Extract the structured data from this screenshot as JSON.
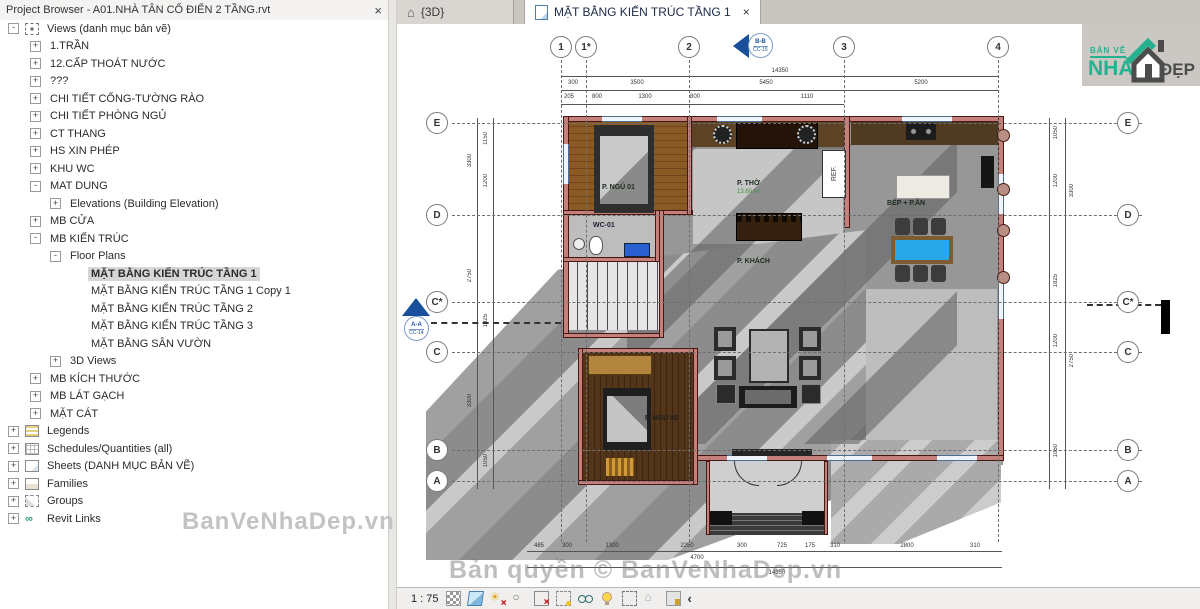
{
  "browser": {
    "title": "Project Browser - A01.NHÀ TÂN CỔ ĐIỂN 2 TẦNG.rvt",
    "close": "×",
    "watermark": "BanVeNhaDep.vn",
    "items": [
      {
        "label": "Views (danh mục bản vẽ)",
        "expanded": true
      },
      {
        "label": "1.TRẦN",
        "expanded": false
      },
      {
        "label": "12.CẤP THOÁT NƯỚC",
        "expanded": false
      },
      {
        "label": "???",
        "expanded": false
      },
      {
        "label": "CHI TIẾT CỔNG-TƯỜNG RÀO",
        "expanded": false
      },
      {
        "label": "CHI TIẾT PHÒNG NGỦ",
        "expanded": false
      },
      {
        "label": "CT THANG",
        "expanded": false
      },
      {
        "label": "HS XIN PHÉP",
        "expanded": false
      },
      {
        "label": "KHU WC",
        "expanded": false
      },
      {
        "label": "MAT DUNG",
        "expanded": true
      },
      {
        "label": "Elevations (Building Elevation)",
        "expanded": false
      },
      {
        "label": "MB CỬA",
        "expanded": false
      },
      {
        "label": "MB KIẾN TRÚC",
        "expanded": true
      },
      {
        "label": "Floor Plans",
        "expanded": true
      },
      {
        "label": "MẶT BẰNG KIẾN TRÚC TẦNG 1",
        "selected": true
      },
      {
        "label": "MẶT BẰNG KIẾN TRÚC TẦNG 1 Copy 1"
      },
      {
        "label": "MẶT BẰNG KIẾN TRÚC TẦNG 2"
      },
      {
        "label": "MẶT BẰNG KIẾN TRÚC TẦNG 3"
      },
      {
        "label": "MẶT BẰNG SÂN VƯỜN"
      },
      {
        "label": "3D Views",
        "expanded": false
      },
      {
        "label": "MB KÍCH THƯỚC",
        "expanded": false
      },
      {
        "label": "MB LÁT GẠCH",
        "expanded": false
      },
      {
        "label": "MẶT CÁT",
        "expanded": false
      },
      {
        "label": "Legends",
        "expanded": false
      },
      {
        "label": "Schedules/Quantities (all)",
        "expanded": false
      },
      {
        "label": "Sheets (DANH MỤC BẢN VẼ)",
        "expanded": false
      },
      {
        "label": "Families",
        "expanded": false
      },
      {
        "label": "Groups",
        "expanded": false
      },
      {
        "label": "Revit Links",
        "expanded": false
      }
    ]
  },
  "tabs": {
    "three_d": "{3D}",
    "active": "MẶT BẰNG KIẾN TRÚC TẦNG 1",
    "close": "×"
  },
  "logo": {
    "top": "BẢN VẼ",
    "main": "NHÀ",
    "suffix": "ĐẸP"
  },
  "plan": {
    "grids": {
      "top": [
        "1",
        "1*",
        "2",
        "3",
        "4"
      ],
      "left": [
        "E",
        "D",
        "C*",
        "C",
        "B",
        "A"
      ],
      "right": [
        "E",
        "D",
        "C*",
        "C",
        "B",
        "A"
      ]
    },
    "sections": {
      "top": {
        "name": "B-B",
        "ref": "CC-15"
      },
      "left": {
        "name": "A-A",
        "ref": "CC-14"
      }
    },
    "rooms": [
      {
        "name": "P. NGỦ 01"
      },
      {
        "name": "WC-01"
      },
      {
        "name": "P. THỜ",
        "area": "13.60 m²"
      },
      {
        "name": "P. KHÁCH"
      },
      {
        "name": "BẾP + P.ĂN"
      },
      {
        "name": "P. NGỦ 02"
      }
    ],
    "ref_label": "REF.",
    "dims": {
      "top_total": "14350",
      "top_major": [
        "300",
        "3500",
        "5450",
        "5200"
      ],
      "top_minor": [
        "205",
        "800",
        "1300",
        "800",
        "1110"
      ],
      "left_outer": [
        "3300",
        "2750",
        "3300"
      ],
      "left_inner": [
        "1150",
        "1200",
        "1825",
        "1050"
      ],
      "right_outer": [
        "3300",
        "2750"
      ],
      "right_inner": [
        "1050",
        "1200",
        "1825",
        "1200",
        "1050"
      ],
      "bottom_minor": [
        "485",
        "300",
        "1300",
        "2250",
        "300",
        "725",
        "175",
        "310",
        "2800",
        "310"
      ],
      "bottom_mid": "4700",
      "bottom_total": "14350"
    }
  },
  "statusbar": {
    "scale": "1 : 75",
    "back": "‹"
  },
  "watermark_canvas": "Bản quyền © BanVeNhaDep.vn"
}
